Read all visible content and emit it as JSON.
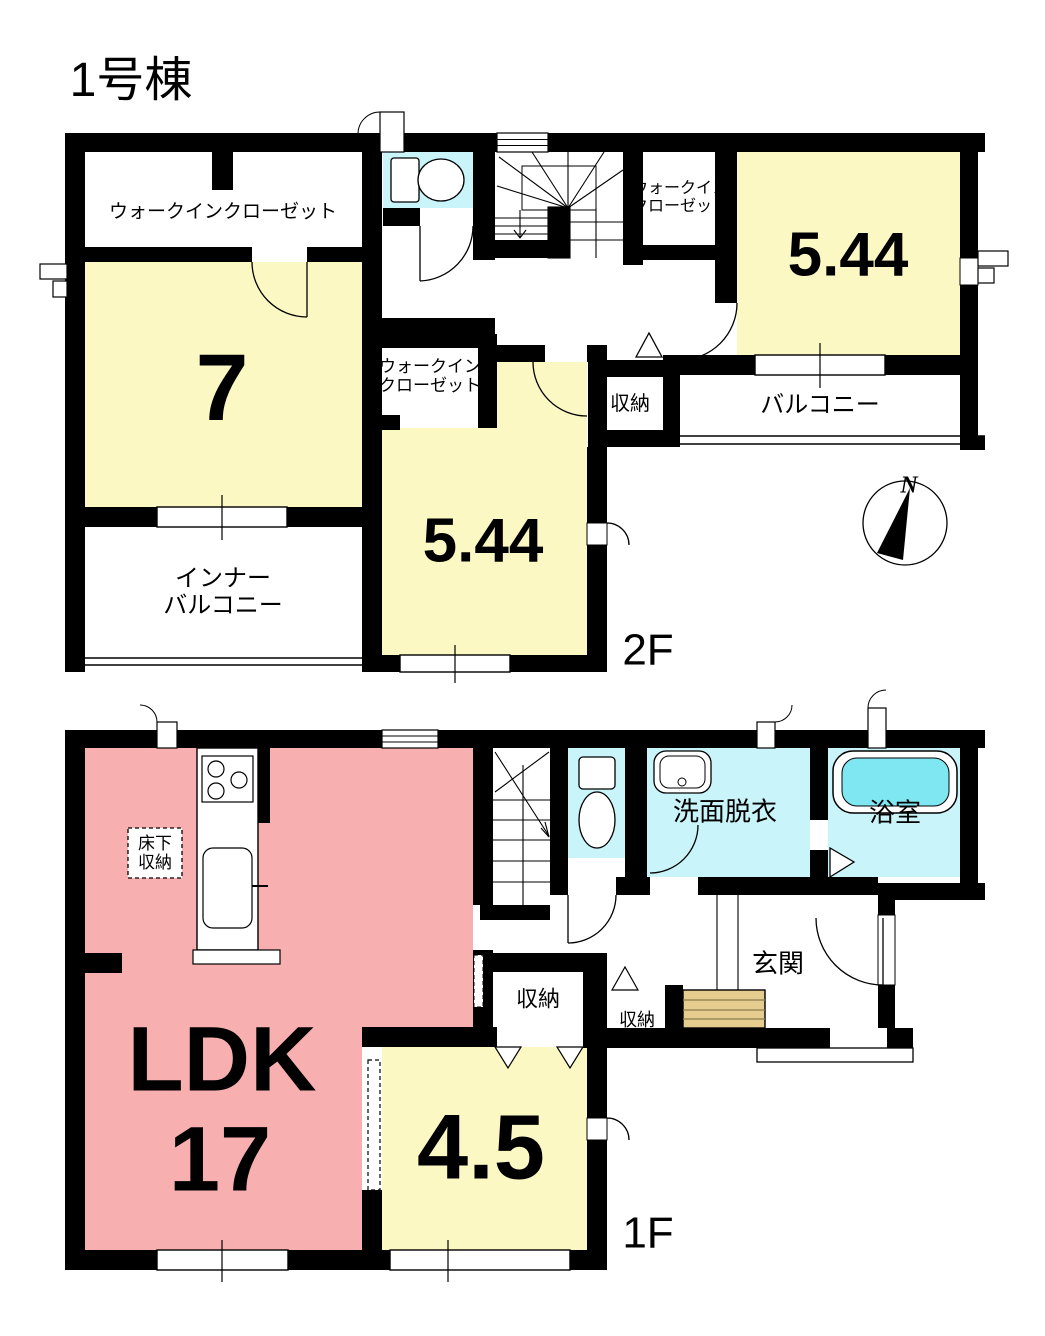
{
  "title": "1号棟",
  "colors": {
    "wall": "#000000",
    "room_yellow": "#FCF8C4",
    "room_pink": "#F8AFB0",
    "water_cyan": "#C9F4F9",
    "tub_cyan": "#7EE7F2",
    "step_tan": "#E6CC8F"
  },
  "floor2": {
    "floor_label": "2F",
    "compass": "N",
    "walk_in_closet_left": "ウォークインクローゼット",
    "room7_size": "7",
    "inner_balcony": [
      "インナー",
      "バルコニー"
    ],
    "walk_in_closet_mid": [
      "ウォークイン",
      "クローゼット"
    ],
    "room_mid_size": "5.44",
    "storage": "収納",
    "walk_in_closet_right": [
      "ウォークイン",
      "クローゼット"
    ],
    "room_right_size": "5.44",
    "balcony": "バルコニー"
  },
  "floor1": {
    "floor_label": "1F",
    "ldk_label": "LDK",
    "ldk_size": "17",
    "underfloor_storage": [
      "床下",
      "収納"
    ],
    "washroom": "洗面脱衣",
    "bathroom": "浴室",
    "entrance": "玄関",
    "storage_hall": "収納",
    "storage_entrance": "収納",
    "room_45_size": "4.5"
  }
}
